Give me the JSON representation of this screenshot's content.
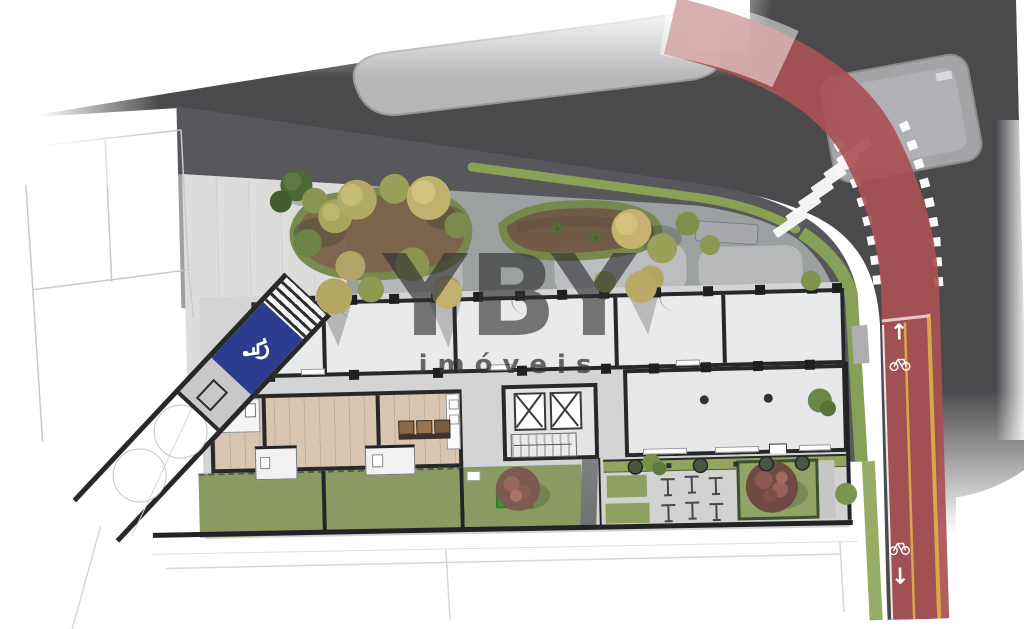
{
  "page": {
    "type": "architectural-site-plan",
    "description": "Ground floor implantation plan rendering with street, cycle lane, garden and building footprint"
  },
  "watermark": {
    "brand": "YBY",
    "subtitle": "imóveis"
  },
  "icons": {
    "wheelchair": "♿",
    "arrow_up": "↑",
    "arrow_down": "↓",
    "bicycle": "bicycle-icon"
  },
  "palette": {
    "road": "#4a4a4d",
    "sidewalk_band": "#58585c",
    "garden_paving": "#9da0a1",
    "plaza": "#dcdcda",
    "building_floor": "#e9eaec",
    "wood_floor": "#d8c6b1",
    "wall": "#28282a",
    "lawn": "#8b9a63",
    "hedge": "#44552f",
    "garden_bed": "#7a6048",
    "bike_lane": "#a85154",
    "lane_marking": "#d9a849",
    "accessible_blue": "#2c3d90",
    "traffic_island": "#a4a4a7",
    "crosswalk": "#fafafa"
  }
}
